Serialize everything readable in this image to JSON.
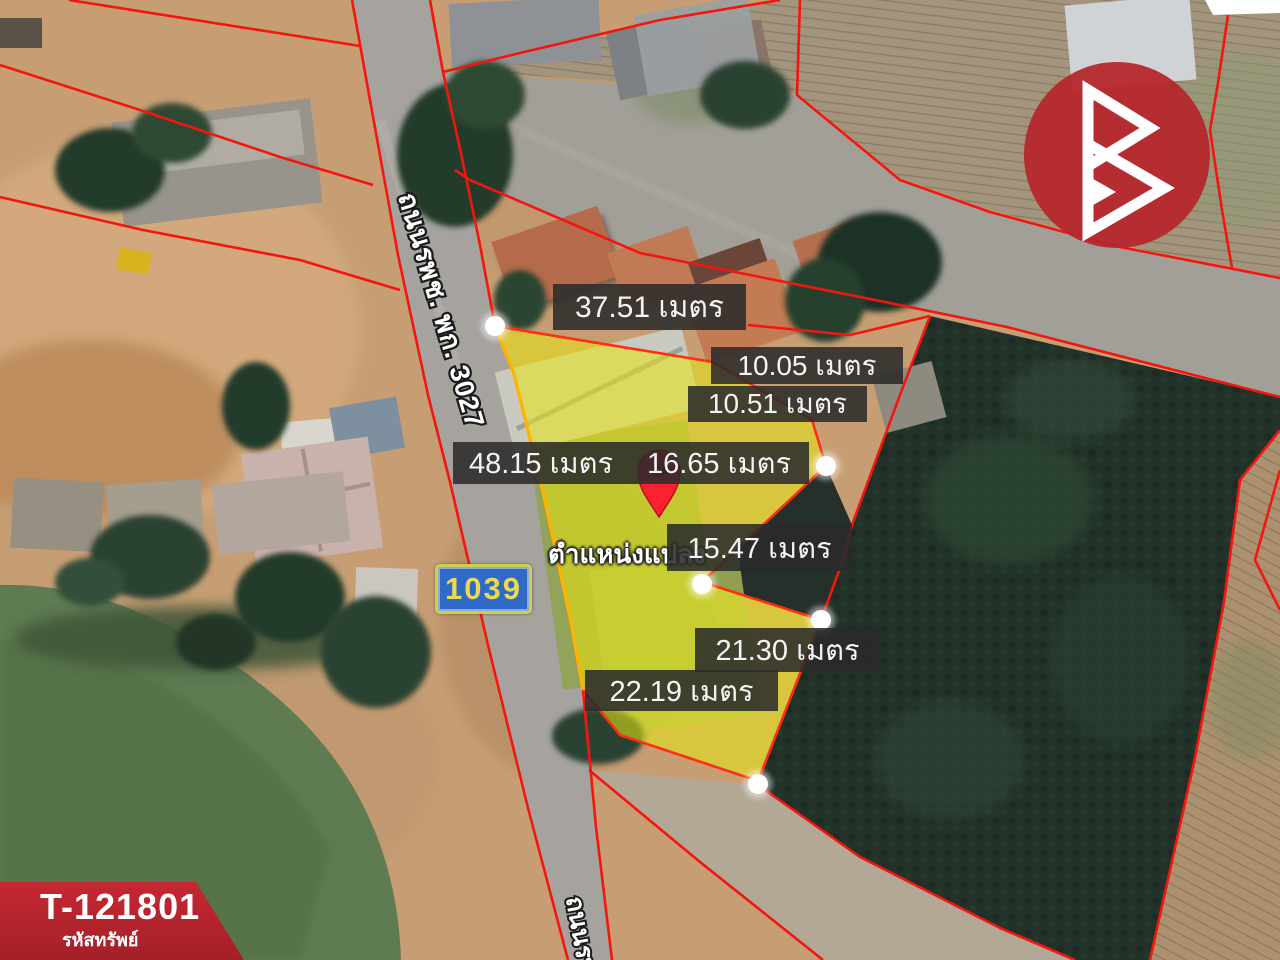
{
  "property": {
    "code": "T-121801",
    "code_label": "รหัสทรัพย์"
  },
  "map": {
    "road_sign": "1039",
    "road_name": "ถนนรพช. พก. 3027",
    "road_name_secondary": "ถนนรพ",
    "plot_marker_label": "ตำแหน่งแปลง",
    "measurements": [
      {
        "side": "north",
        "text": "37.51 เมตร"
      },
      {
        "side": "northeast-upper",
        "text": "10.05 เมตร"
      },
      {
        "side": "northeast-lower",
        "text": "10.51 เมตร"
      },
      {
        "side": "west",
        "text": "48.15 เมตร"
      },
      {
        "side": "east-upper",
        "text": "16.65 เมตร"
      },
      {
        "side": "east-middle",
        "text": "15.47 เมตร"
      },
      {
        "side": "southeast",
        "text": "21.30 เมตร"
      },
      {
        "side": "south",
        "text": "22.19 เมตร"
      }
    ],
    "colors": {
      "plot_fill": "#e8e814",
      "boundary_red": "#f5150f",
      "plot_edge_orange": "#ffb300",
      "label_bg": "rgba(43,43,43,0.87)",
      "sign_bg": "#2f6ac8",
      "sign_text": "#ecd94d",
      "banner_red": "#c52832",
      "pin_red": "#fe2130",
      "water_green": "#5e7b52",
      "forest_dark": "#223229",
      "logo_red": "#b6262c"
    }
  }
}
